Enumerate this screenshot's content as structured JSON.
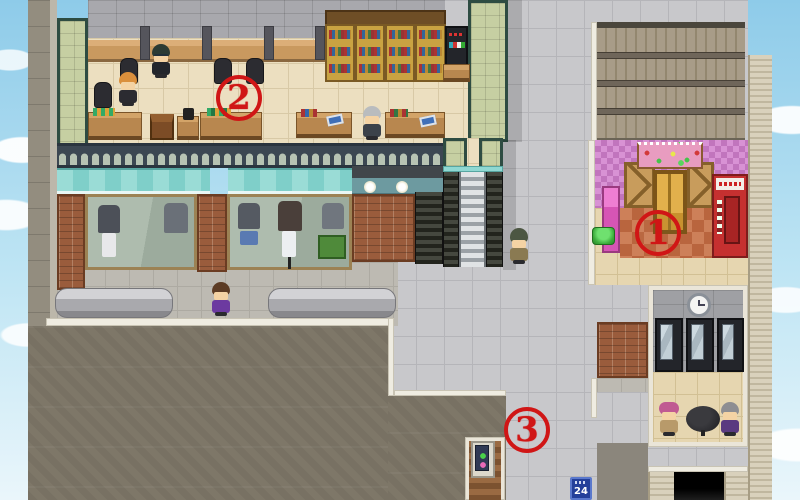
{
  "scene": {
    "type": "rpg-town-map-screenshot",
    "description": "Top-down RPG town plaza with office, clothing shop, flower shop, rest room and red circled location markers"
  },
  "annotations": {
    "a1": {
      "label": "1",
      "x": 662,
      "y": 237,
      "marks": "flower-shop-entrance"
    },
    "a2": {
      "label": "2",
      "x": 243,
      "y": 102,
      "marks": "office-interior"
    },
    "a3": {
      "label": "3",
      "x": 531,
      "y": 434,
      "marks": "street-vending-machine"
    },
    "color": "#d01616"
  },
  "signs": {
    "convenience_24_sign": "24"
  },
  "areas": {
    "office": "open-plan office with desks, chairs, bookshelves, counters and drink station",
    "clothing_shop_front": "display windows with mannequins under teal awnings",
    "flower_shop": "pink checkered wall, flower banner, crates, gold door, red vending machine",
    "rest_room": "room with wall clock, three vending machines, round table with two NPCs",
    "escalator": "escalator connecting office level to plaza",
    "plaza": "gray tiled pedestrian plaza",
    "road": "dark asphalt road at bottom left",
    "garage": "dark garage opening at bottom right"
  },
  "npcs": {
    "office_worker_glasses": "dark-haired man in suit at desk",
    "office_worker_orange_hair": "orange-haired woman in suit",
    "office_elder": "gray-haired man near counters",
    "helmet_pedestrian": "green-capped man beside escalator",
    "purple_shirt_pedestrian": "brown-haired man in purple shirt at benches",
    "pink_hat_woman": "woman with pink hat at round table",
    "purple_suit_elder": "gray-haired man in purple at round table"
  },
  "colors": {
    "annotation_red": "#d01616",
    "plaza_tile": "#c8c8cb",
    "road": "#7e7768",
    "office_floor": "#ecdfc0",
    "green_wall": "#c6cfa2",
    "awning_teal": "#8fd8d2",
    "flower_wall_pink": "#d892d4",
    "sign_blue": "#24409a",
    "sky": "#9fd4ee"
  }
}
